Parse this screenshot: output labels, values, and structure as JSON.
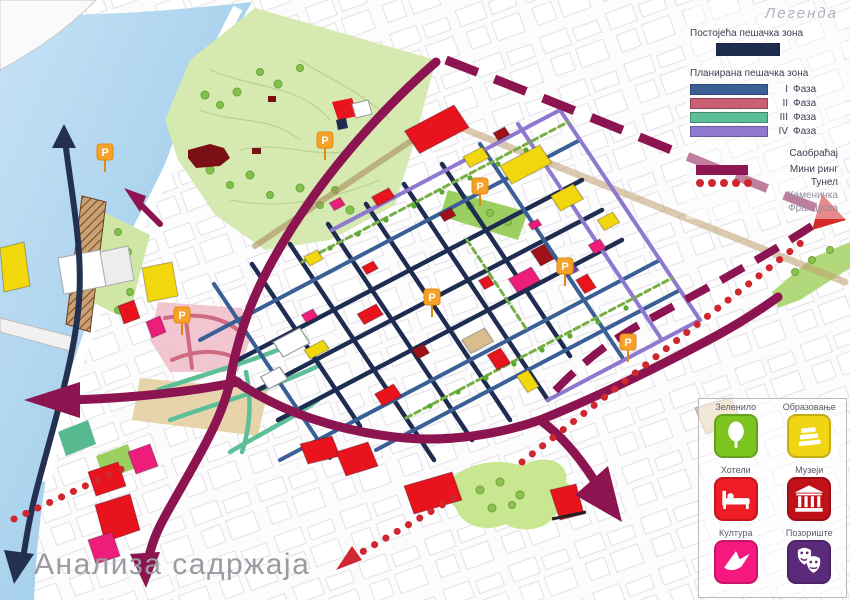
{
  "title": "Анализа садржаја",
  "legend": {
    "heading": "Легенда",
    "existing_zone": {
      "label": "Постојећа пешачка зона",
      "color": "#1d2b4e"
    },
    "planned_zone": {
      "label": "Планирана пешачка зона",
      "phases": [
        {
          "numeral": "I",
          "label": "Фаза",
          "color": "#3a5f95"
        },
        {
          "numeral": "II",
          "label": "Фаза",
          "color": "#c95f70"
        },
        {
          "numeral": "III",
          "label": "Фаза",
          "color": "#5dbf98"
        },
        {
          "numeral": "IV",
          "label": "Фаза",
          "color": "#8f79cf"
        }
      ]
    },
    "traffic": {
      "heading": "Саобраћај",
      "items": [
        {
          "label": "Мини ринг",
          "symbol": "solid-bar",
          "color": "#8e1653"
        },
        {
          "label": "Тунел",
          "symbol": "red-dots",
          "color": "#cf2630"
        },
        {
          "label": "Каменичка",
          "symbol": "none"
        },
        {
          "label": "Француска",
          "symbol": "none"
        }
      ]
    }
  },
  "amenities_legend": {
    "items": [
      {
        "label": "Зеленило",
        "icon": "tree-icon",
        "color": "#7cc520"
      },
      {
        "label": "Образовање",
        "icon": "education-icon",
        "color": "#f0d515"
      },
      {
        "label": "Хотели",
        "icon": "hotel-bed-icon",
        "color": "#ee1c25"
      },
      {
        "label": "Музеји",
        "icon": "museum-icon",
        "color": "#c01018"
      },
      {
        "label": "Култура",
        "icon": "culture-bird-icon",
        "color": "#f5197f"
      },
      {
        "label": "Позориште",
        "icon": "theater-masks-icon",
        "color": "#5c2a7a"
      }
    ]
  },
  "map": {
    "parking_label": "P",
    "parking_color": "#f6a229",
    "ring_color": "#8c1450",
    "tunnel_color": "#cf2630",
    "water_color": "#9cc8e8",
    "park_color": "#d6e9b0"
  }
}
